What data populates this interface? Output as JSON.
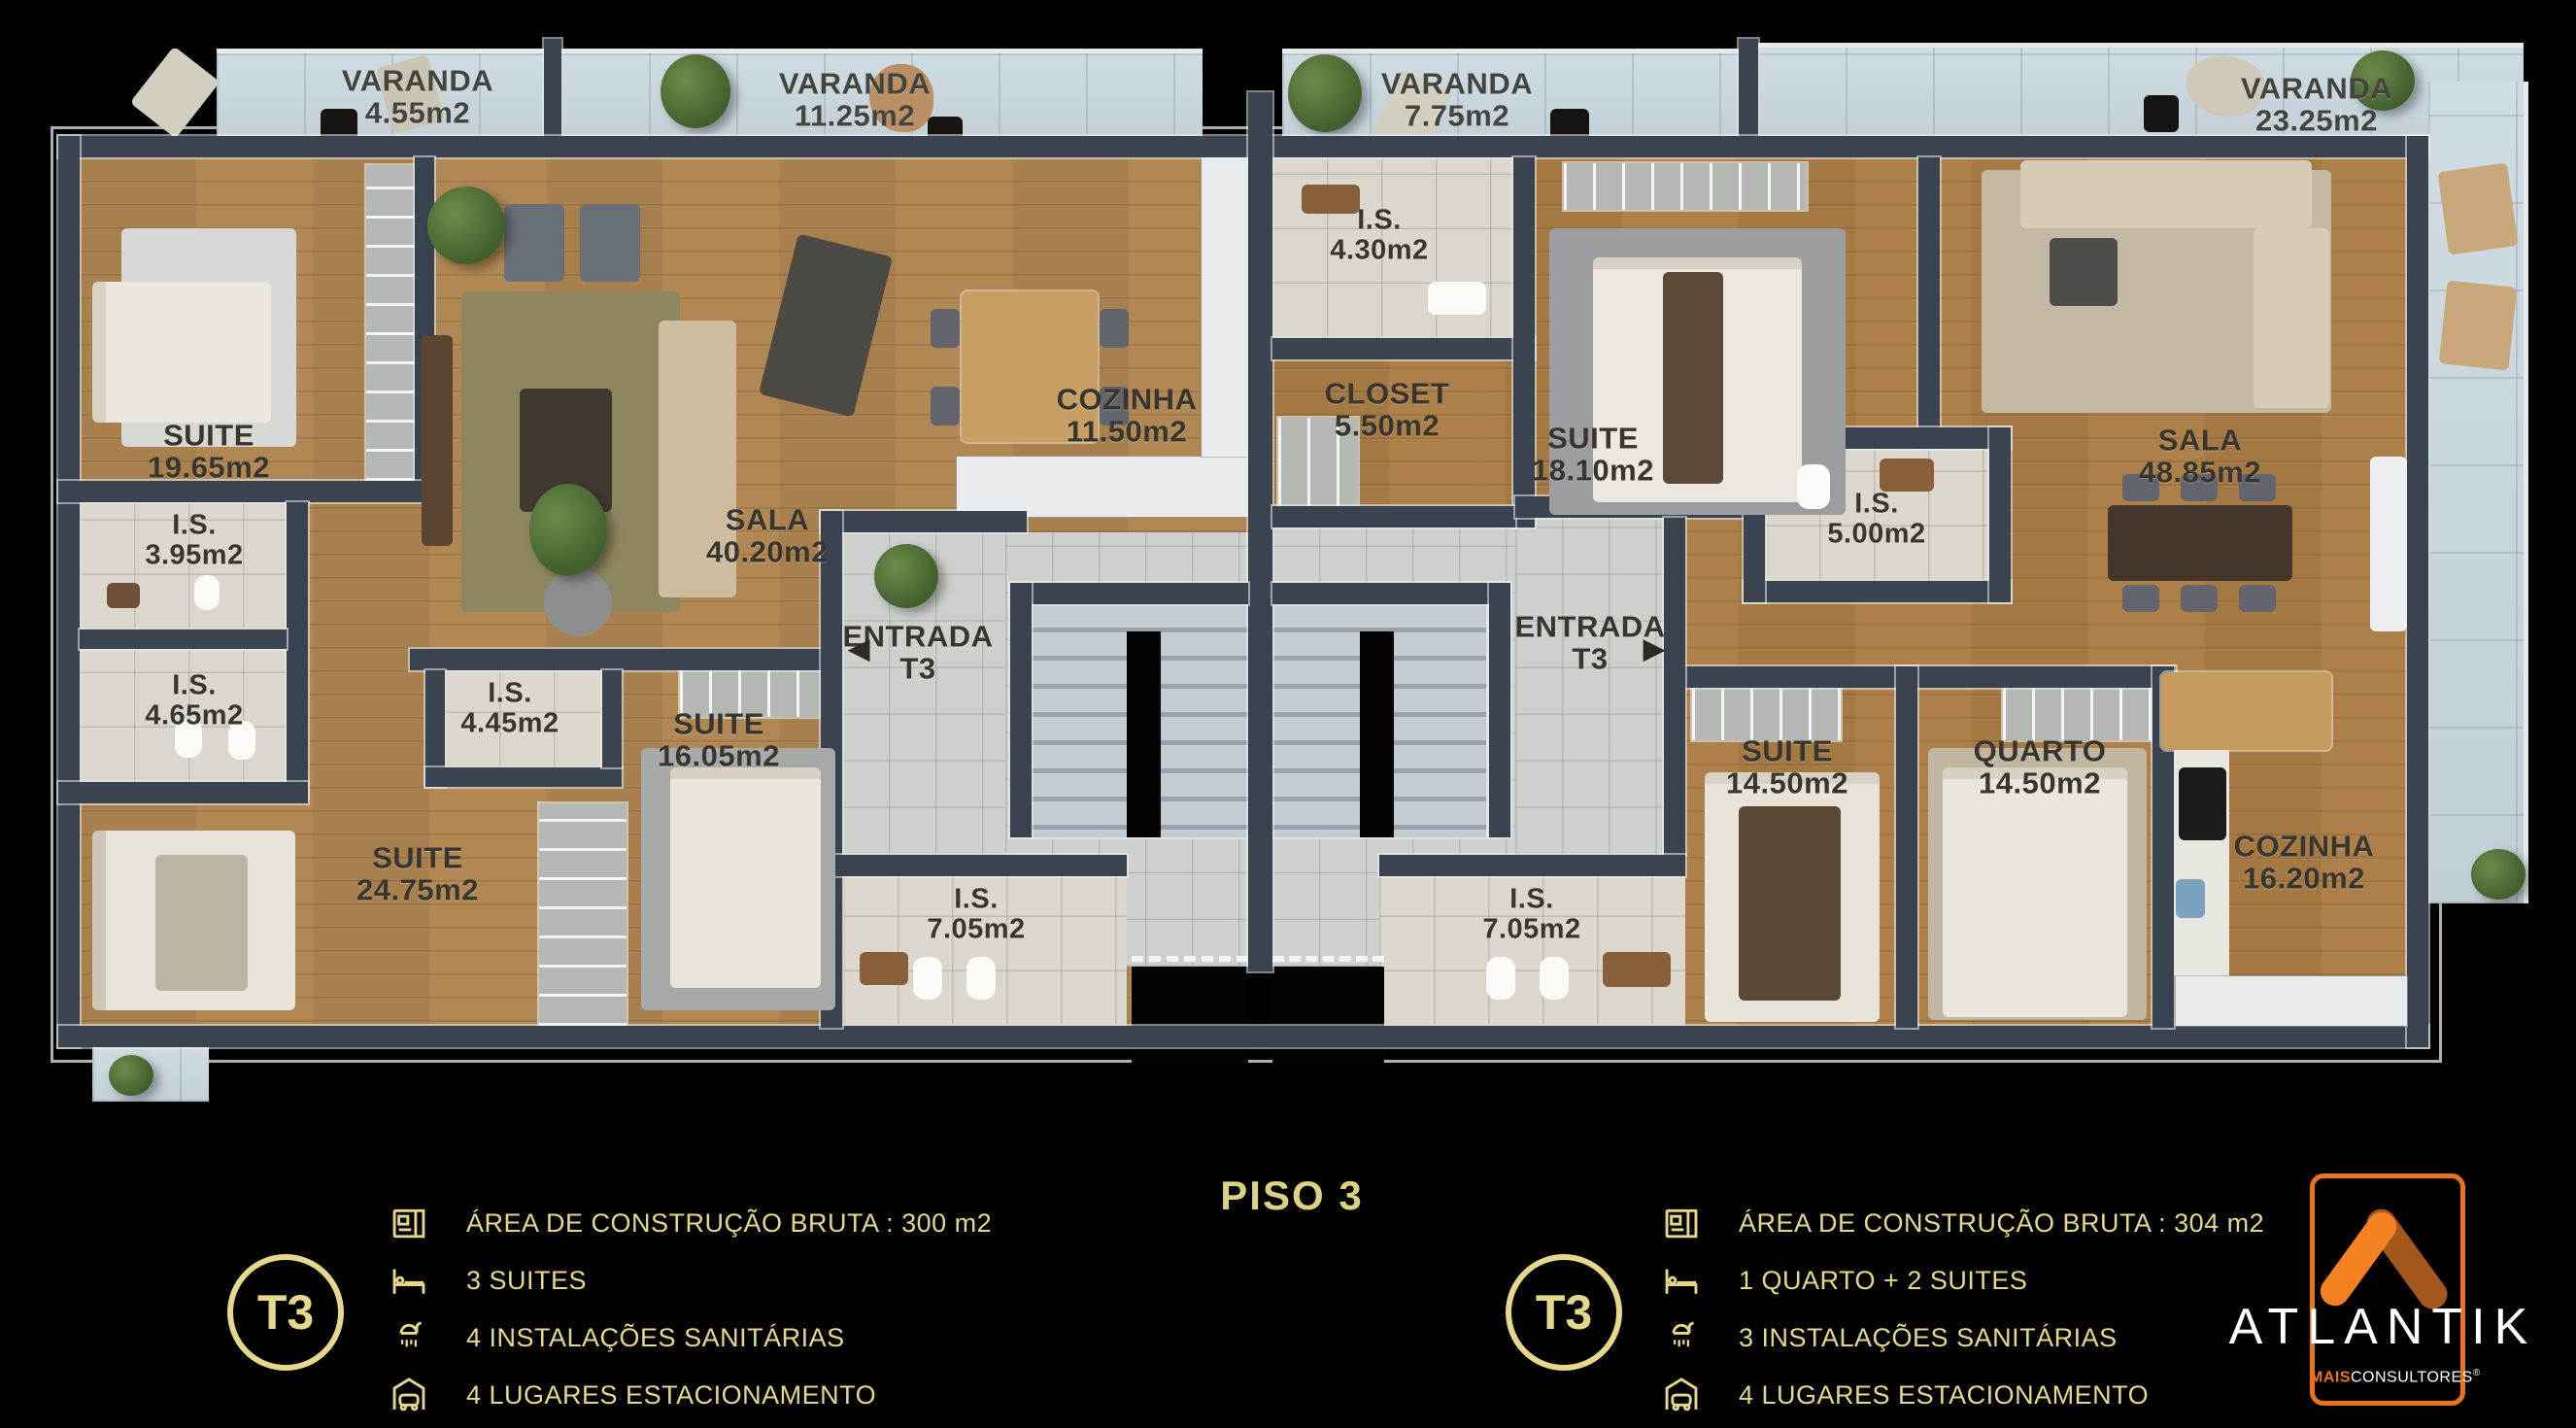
{
  "floor": {
    "label": "PISO 3"
  },
  "plan": {
    "varandas": [
      {
        "name": "VARANDA",
        "area": "4.55m2"
      },
      {
        "name": "VARANDA",
        "area": "11.25m2"
      },
      {
        "name": "VARANDA",
        "area": "7.75m2"
      },
      {
        "name": "VARANDA",
        "area": "23.25m2"
      }
    ],
    "left_rooms": [
      {
        "name": "SUITE",
        "area": "19.65m2"
      },
      {
        "name": "I.S.",
        "area": "3.95m2"
      },
      {
        "name": "I.S.",
        "area": "4.65m2"
      },
      {
        "name": "I.S.",
        "area": "4.45m2"
      },
      {
        "name": "SUITE",
        "area": "24.75m2"
      },
      {
        "name": "SUITE",
        "area": "16.05m2"
      },
      {
        "name": "SALA",
        "area": "40.20m2"
      },
      {
        "name": "COZINHA",
        "area": "11.50m2"
      },
      {
        "name": "ENTRADA",
        "area": "T3"
      },
      {
        "name": "I.S.",
        "area": "7.05m2"
      }
    ],
    "right_rooms": [
      {
        "name": "I.S.",
        "area": "4.30m2"
      },
      {
        "name": "CLOSET",
        "area": "5.50m2"
      },
      {
        "name": "SUITE",
        "area": "18.10m2"
      },
      {
        "name": "I.S.",
        "area": "5.00m2"
      },
      {
        "name": "ENTRADA",
        "area": "T3"
      },
      {
        "name": "I.S.",
        "area": "7.05m2"
      },
      {
        "name": "SUITE",
        "area": "14.50m2"
      },
      {
        "name": "QUARTO",
        "area": "14.50m2"
      },
      {
        "name": "SALA",
        "area": "48.85m2"
      },
      {
        "name": "COZINHA",
        "area": "16.20m2"
      }
    ],
    "icons": {
      "entry_arrow_left": "◀",
      "entry_arrow_right": "▶"
    }
  },
  "legend_left": {
    "badge": "T3",
    "rows": [
      {
        "icon": "blueprint-icon",
        "text": "ÁREA DE CONSTRUÇÃO BRUTA :  300 m2"
      },
      {
        "icon": "bed-icon",
        "text": "3 SUITES"
      },
      {
        "icon": "shower-icon",
        "text": "4 INSTALAÇÕES SANITÁRIAS"
      },
      {
        "icon": "garage-icon",
        "text": "4 LUGARES ESTACIONAMENTO"
      }
    ]
  },
  "legend_right": {
    "badge": "T3",
    "rows": [
      {
        "icon": "blueprint-icon",
        "text": "ÁREA DE CONSTRUÇÃO BRUTA :  304 m2"
      },
      {
        "icon": "bed-icon",
        "text": "1 QUARTO + 2 SUITES"
      },
      {
        "icon": "shower-icon",
        "text": "3 INSTALAÇÕES SANITÁRIAS"
      },
      {
        "icon": "garage-icon",
        "text": "4 LUGARES ESTACIONAMENTO"
      }
    ]
  },
  "brand": {
    "name": "ATLANTIK",
    "tagline_bold": "MAIS",
    "tagline_rest": "CONSULTORES",
    "registered": "®"
  },
  "colors": {
    "gold": "#e5d88a",
    "orange": "#ec7418",
    "orange_dark": "#a4571d",
    "wall": "#3a4450",
    "wood": "#b18853",
    "tile": "#dbd7cd",
    "concrete": "#c7d4db",
    "background": "#000000"
  }
}
